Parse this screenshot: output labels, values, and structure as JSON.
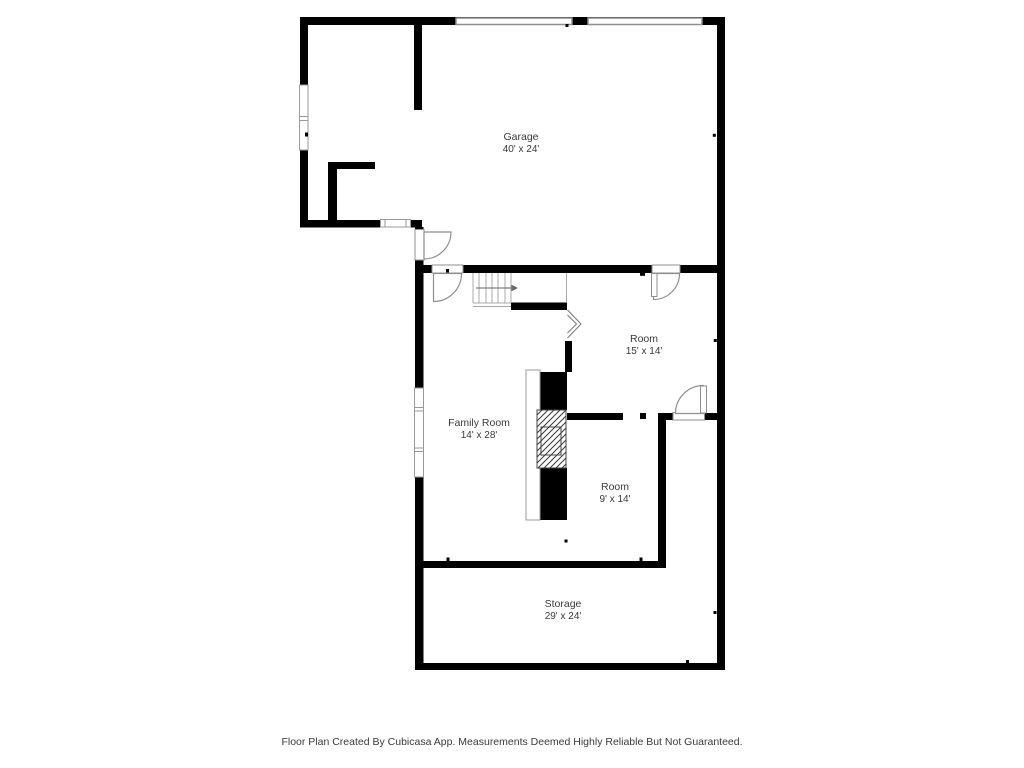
{
  "floor_plan": {
    "rooms": [
      {
        "name": "Garage",
        "dimensions": "40' x 24'"
      },
      {
        "name": "Room",
        "dimensions": "15' x 14'"
      },
      {
        "name": "Family Room",
        "dimensions": "14' x 28'"
      },
      {
        "name": "Room",
        "dimensions": "9' x 14'"
      },
      {
        "name": "Storage",
        "dimensions": "29' x 24'"
      }
    ],
    "footer": "Floor Plan Created By Cubicasa App. Measurements Deemed Highly Reliable But Not Guaranteed.",
    "colors": {
      "background": "#ffffff",
      "wall": "#000000",
      "fixture_outline": "#8f8f8f",
      "stair_outline": "#a8a8a8",
      "label_text": "#3a3a3a"
    }
  }
}
